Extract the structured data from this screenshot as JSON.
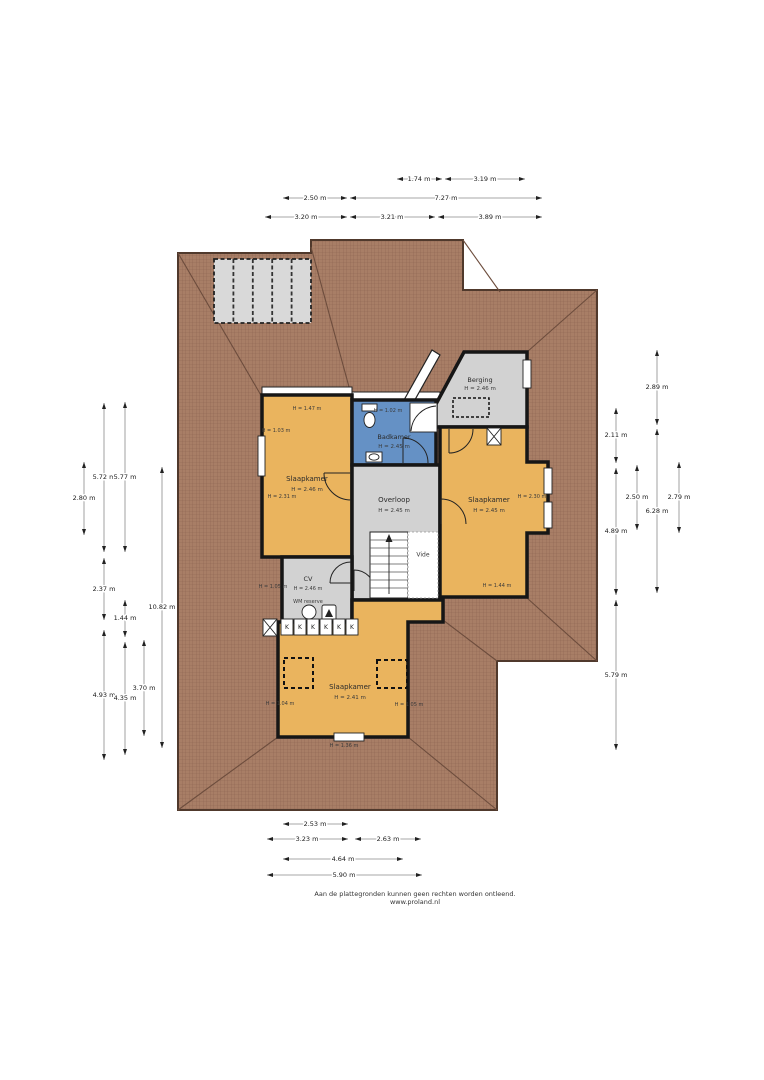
{
  "footer": {
    "disclaimer": "Aan de plattegronden kunnen geen rechten worden ontleend.",
    "website": "www.proland.nl"
  },
  "colors": {
    "roof": "#a87e66",
    "roof_edge": "#50392c",
    "orange_room": "#eab45e",
    "blue_room": "#6591c5",
    "gray_room": "#d2d2d2",
    "panel_gray": "#d9d9d9",
    "wall": "#161616"
  },
  "rooms": {
    "slaapkamer_left": {
      "name": "Slaapkamer",
      "height": "H = 2.46 m",
      "knee_top": "H = 1.47 m",
      "knee_left": "H = 1.03 m",
      "corner": "H = 2.31 m"
    },
    "badkamer": {
      "name": "Badkamer",
      "height": "H = 2.45 m",
      "knee_top": "H = 1.02 m"
    },
    "berging": {
      "name": "Berging",
      "height": "H = 2.46 m"
    },
    "overloop": {
      "name": "Overloop",
      "height": "H = 2.45 m"
    },
    "slaapkamer_right": {
      "name": "Slaapkamer",
      "height": "H = 2.45 m",
      "knee_right": "H = 2.30 m",
      "knee_bottom": "H = 1.44 m"
    },
    "cv": {
      "name": "CV",
      "height": "H = 2.46 m",
      "sub": "WM reserve",
      "knee_left": "H = 1.05 m"
    },
    "vide": {
      "name": "Vide"
    },
    "slaapkamer_bottom": {
      "name": "Slaapkamer",
      "height": "H = 2.41 m",
      "knee_left": "H = 1.04 m",
      "knee_right": "H = 1.05 m",
      "knee_bottom": "H = 1.36 m"
    },
    "kast_label": "K"
  },
  "dims": {
    "t1": "1.74 m",
    "t2": "3.19 m",
    "t3": "2.50 m",
    "t4": "7.27 m",
    "t5": "3.20 m",
    "t6": "3.21 m",
    "t7": "3.89 m",
    "l1": "2.80 m",
    "l2": "5.72 m",
    "l3": "2.37 m",
    "l4": "4.93 m",
    "l5": "5.77 m",
    "l6": "1.44 m",
    "l7": "4.35 m",
    "l8": "3.70 m",
    "l9": "10.82 m",
    "r1": "2.11 m",
    "r2": "4.89 m",
    "r3": "5.79 m",
    "r4": "2.50 m",
    "r5": "2.89 m",
    "r6": "6.28 m",
    "r7": "2.79 m",
    "b1": "2.53 m",
    "b2": "3.23 m",
    "b3": "2.63 m",
    "b4": "4.64 m",
    "b5": "5.90 m"
  }
}
